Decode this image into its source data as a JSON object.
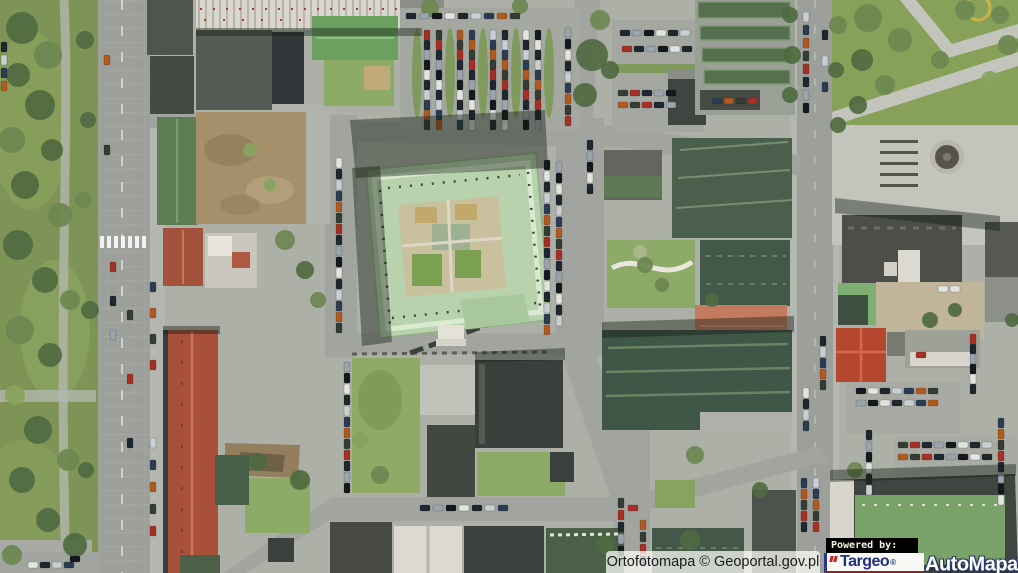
{
  "map": {
    "type": "orthophoto-aerial",
    "attribution": "Ortofotomapa © Geoportal.gov.pl"
  },
  "branding": {
    "powered_by": "Powered by:",
    "targeo": "Targeo",
    "targeo_registered": "®",
    "automapa": "AutoMapa",
    "automapa_registered": "®",
    "targeo_blue": "#20307e",
    "targeo_red": "#c1271f"
  },
  "scene": {
    "palette": {
      "ground": "#adb0a6",
      "road": "#9da09a",
      "plaza": "#c3c5bd",
      "park": "#7d9456",
      "lawn": "#8cab66",
      "dirt": "#a6906c",
      "palace_roof": "#b7d2ac",
      "dark_green_roof": "#44584a",
      "dark_roof": "#3e423e",
      "red_roof": "#a8503a",
      "bright_red_roof": "#b5472e",
      "white_roof": "#ddd9d0",
      "mint_roof": "#7fae72"
    },
    "car_colors": [
      "#1e2732",
      "#e2e4e0",
      "#2b3d55",
      "#a62f26",
      "#15181e",
      "#c9ced2",
      "#333d33",
      "#9aa4ae",
      "#20262e",
      "#b25a1e"
    ],
    "car_rows": [
      {
        "x": 406,
        "y": 13,
        "dx": 13,
        "dy": 0,
        "n": 9,
        "o": "h"
      },
      {
        "x": 424,
        "y": 30,
        "dx": 0,
        "dy": 10,
        "n": 10,
        "o": "v"
      },
      {
        "x": 436,
        "y": 30,
        "dx": 0,
        "dy": 10,
        "n": 10,
        "o": "v"
      },
      {
        "x": 457,
        "y": 30,
        "dx": 0,
        "dy": 10,
        "n": 10,
        "o": "v"
      },
      {
        "x": 469,
        "y": 30,
        "dx": 0,
        "dy": 10,
        "n": 10,
        "o": "v"
      },
      {
        "x": 490,
        "y": 30,
        "dx": 0,
        "dy": 10,
        "n": 10,
        "o": "v"
      },
      {
        "x": 502,
        "y": 30,
        "dx": 0,
        "dy": 10,
        "n": 10,
        "o": "v"
      },
      {
        "x": 523,
        "y": 30,
        "dx": 0,
        "dy": 10,
        "n": 10,
        "o": "v"
      },
      {
        "x": 535,
        "y": 30,
        "dx": 0,
        "dy": 10,
        "n": 10,
        "o": "v"
      },
      {
        "x": 565,
        "y": 28,
        "dx": 0,
        "dy": 11,
        "n": 9,
        "o": "v"
      },
      {
        "x": 620,
        "y": 30,
        "dx": 12,
        "dy": 0,
        "n": 6,
        "o": "h"
      },
      {
        "x": 622,
        "y": 46,
        "dx": 12,
        "dy": 0,
        "n": 6,
        "o": "h"
      },
      {
        "x": 618,
        "y": 90,
        "dx": 12,
        "dy": 0,
        "n": 5,
        "o": "h"
      },
      {
        "x": 618,
        "y": 102,
        "dx": 12,
        "dy": 0,
        "n": 5,
        "o": "h"
      },
      {
        "x": 712,
        "y": 98,
        "dx": 12,
        "dy": 0,
        "n": 4,
        "o": "h"
      },
      {
        "x": 803,
        "y": 12,
        "dx": 0,
        "dy": 13,
        "n": 8,
        "o": "v"
      },
      {
        "x": 822,
        "y": 30,
        "dx": 0,
        "dy": 26,
        "n": 3,
        "o": "v"
      },
      {
        "x": 336,
        "y": 158,
        "dx": 0,
        "dy": 11,
        "n": 16,
        "o": "v"
      },
      {
        "x": 544,
        "y": 160,
        "dx": 0,
        "dy": 11,
        "n": 16,
        "o": "v"
      },
      {
        "x": 556,
        "y": 162,
        "dx": 0,
        "dy": 11,
        "n": 15,
        "o": "v"
      },
      {
        "x": 587,
        "y": 140,
        "dx": 0,
        "dy": 11,
        "n": 5,
        "o": "v"
      },
      {
        "x": 110,
        "y": 262,
        "dx": 0,
        "dy": 34,
        "n": 3,
        "o": "v"
      },
      {
        "x": 127,
        "y": 310,
        "dx": 0,
        "dy": 64,
        "n": 3,
        "o": "v"
      },
      {
        "x": 104,
        "y": 55,
        "dx": 0,
        "dy": 90,
        "n": 2,
        "o": "v"
      },
      {
        "x": 150,
        "y": 282,
        "dx": 0,
        "dy": 26,
        "n": 4,
        "o": "v"
      },
      {
        "x": 150,
        "y": 438,
        "dx": 0,
        "dy": 22,
        "n": 5,
        "o": "v"
      },
      {
        "x": 1,
        "y": 42,
        "dx": 0,
        "dy": 13,
        "n": 4,
        "o": "v"
      },
      {
        "x": 28,
        "y": 562,
        "dx": 12,
        "dy": 0,
        "n": 4,
        "o": "h"
      },
      {
        "x": 70,
        "y": 556,
        "dx": 12,
        "dy": 0,
        "n": 1,
        "o": "h"
      },
      {
        "x": 344,
        "y": 362,
        "dx": 0,
        "dy": 11,
        "n": 12,
        "o": "v"
      },
      {
        "x": 420,
        "y": 505,
        "dx": 13,
        "dy": 0,
        "n": 7,
        "o": "h"
      },
      {
        "x": 628,
        "y": 505,
        "dx": 13,
        "dy": 0,
        "n": 1,
        "o": "h",
        "c": 3
      },
      {
        "x": 618,
        "y": 498,
        "dx": 0,
        "dy": 12,
        "n": 5,
        "o": "v"
      },
      {
        "x": 640,
        "y": 520,
        "dx": 0,
        "dy": 12,
        "n": 4,
        "o": "v"
      },
      {
        "x": 801,
        "y": 478,
        "dx": 0,
        "dy": 11,
        "n": 5,
        "o": "v"
      },
      {
        "x": 813,
        "y": 478,
        "dx": 0,
        "dy": 11,
        "n": 5,
        "o": "v"
      },
      {
        "x": 820,
        "y": 336,
        "dx": 0,
        "dy": 11,
        "n": 5,
        "o": "v"
      },
      {
        "x": 803,
        "y": 388,
        "dx": 0,
        "dy": 11,
        "n": 4,
        "o": "v"
      },
      {
        "x": 856,
        "y": 388,
        "dx": 12,
        "dy": 0,
        "n": 7,
        "o": "h"
      },
      {
        "x": 856,
        "y": 400,
        "dx": 12,
        "dy": 0,
        "n": 7,
        "o": "h"
      },
      {
        "x": 866,
        "y": 430,
        "dx": 0,
        "dy": 11,
        "n": 6,
        "o": "v"
      },
      {
        "x": 970,
        "y": 334,
        "dx": 0,
        "dy": 10,
        "n": 6,
        "o": "v"
      },
      {
        "x": 898,
        "y": 442,
        "dx": 12,
        "dy": 0,
        "n": 8,
        "o": "h"
      },
      {
        "x": 898,
        "y": 454,
        "dx": 12,
        "dy": 0,
        "n": 8,
        "o": "h"
      },
      {
        "x": 998,
        "y": 418,
        "dx": 0,
        "dy": 11,
        "n": 8,
        "o": "v"
      },
      {
        "x": 938,
        "y": 286,
        "dx": 12,
        "dy": 0,
        "n": 2,
        "o": "h",
        "c": 1
      },
      {
        "x": 916,
        "y": 352,
        "dx": 12,
        "dy": 0,
        "n": 1,
        "o": "h",
        "c": 3
      }
    ],
    "trees": [
      [
        22,
        28,
        16,
        0
      ],
      [
        48,
        55,
        14,
        1
      ],
      [
        18,
        75,
        12,
        0
      ],
      [
        40,
        105,
        15,
        0
      ],
      [
        12,
        140,
        13,
        1
      ],
      [
        52,
        150,
        11,
        0
      ],
      [
        25,
        185,
        14,
        0
      ],
      [
        60,
        215,
        12,
        1
      ],
      [
        18,
        245,
        15,
        0
      ],
      [
        45,
        280,
        13,
        0
      ],
      [
        70,
        300,
        10,
        1
      ],
      [
        20,
        330,
        14,
        1
      ],
      [
        50,
        355,
        12,
        0
      ],
      [
        15,
        395,
        10,
        2
      ],
      [
        38,
        430,
        14,
        0
      ],
      [
        68,
        460,
        11,
        1
      ],
      [
        22,
        480,
        13,
        0
      ],
      [
        48,
        520,
        12,
        0
      ],
      [
        75,
        545,
        12,
        0
      ],
      [
        12,
        555,
        10,
        1
      ],
      [
        85,
        40,
        9,
        0
      ],
      [
        88,
        120,
        8,
        0
      ],
      [
        83,
        200,
        8,
        1
      ],
      [
        90,
        310,
        9,
        0
      ],
      [
        86,
        470,
        8,
        0
      ],
      [
        250,
        150,
        7,
        2
      ],
      [
        270,
        185,
        6,
        2
      ],
      [
        285,
        240,
        10,
        1
      ],
      [
        305,
        270,
        9,
        0
      ],
      [
        318,
        300,
        8,
        1
      ],
      [
        430,
        8,
        9,
        1
      ],
      [
        520,
        6,
        8,
        1
      ],
      [
        592,
        55,
        16,
        0
      ],
      [
        585,
        95,
        12,
        0
      ],
      [
        600,
        20,
        10,
        1
      ],
      [
        610,
        70,
        9,
        0
      ],
      [
        790,
        15,
        8,
        0
      ],
      [
        792,
        55,
        9,
        0
      ],
      [
        790,
        95,
        8,
        0
      ],
      [
        838,
        25,
        9,
        1
      ],
      [
        836,
        70,
        8,
        0
      ],
      [
        868,
        18,
        14,
        1
      ],
      [
        900,
        40,
        12,
        1
      ],
      [
        862,
        60,
        11,
        0
      ],
      [
        885,
        85,
        10,
        1
      ],
      [
        940,
        60,
        9,
        1
      ],
      [
        858,
        105,
        9,
        0
      ],
      [
        1008,
        45,
        10,
        1
      ],
      [
        990,
        80,
        9,
        2
      ],
      [
        965,
        10,
        10,
        1
      ],
      [
        1000,
        15,
        9,
        1
      ],
      [
        645,
        265,
        8,
        1
      ],
      [
        662,
        285,
        7,
        1
      ],
      [
        380,
        475,
        9,
        1
      ],
      [
        360,
        440,
        8,
        2
      ],
      [
        300,
        480,
        10,
        0
      ],
      [
        258,
        462,
        9,
        0
      ],
      [
        695,
        455,
        9,
        1
      ],
      [
        712,
        300,
        7,
        0
      ],
      [
        838,
        125,
        8,
        0
      ],
      [
        930,
        320,
        8,
        0
      ],
      [
        955,
        310,
        7,
        0
      ],
      [
        605,
        545,
        9,
        0
      ],
      [
        690,
        540,
        10,
        0
      ],
      [
        760,
        490,
        8,
        0
      ],
      [
        855,
        470,
        8,
        1
      ],
      [
        1012,
        320,
        7,
        0
      ]
    ]
  }
}
